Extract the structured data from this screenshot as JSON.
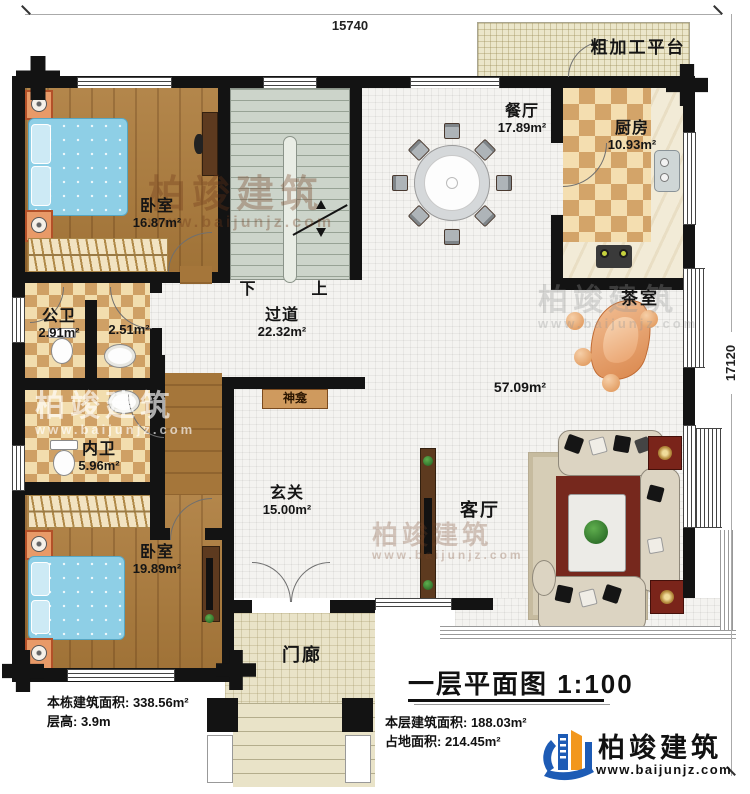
{
  "dimensions": {
    "top": "15740",
    "right": "17120"
  },
  "outdoor": {
    "platform_label": "粗加工平台",
    "porch_label": "门廊"
  },
  "rooms": {
    "bedroom_top": {
      "label": "卧室",
      "area": "16.87m²"
    },
    "bedroom_bottom": {
      "label": "卧室",
      "area": "19.89m²"
    },
    "dining": {
      "label": "餐厅",
      "area": "17.89m²"
    },
    "kitchen": {
      "label": "厨房",
      "area": "10.93m²"
    },
    "public_bath": {
      "label": "公卫",
      "area": "2.91m²"
    },
    "vanity": {
      "area": "2.51m²"
    },
    "ensuite_bath": {
      "label": "内卫",
      "area": "5.96m²"
    },
    "corridor": {
      "label": "过道",
      "area": "22.32m²"
    },
    "foyer": {
      "label": "玄关",
      "area": "15.00m²"
    },
    "tea_room": {
      "label": "茶室"
    },
    "living_room": {
      "label": "客厅"
    },
    "open_area": {
      "area": "57.09m²"
    },
    "shrine": {
      "label": "神龛"
    }
  },
  "stairs": {
    "down_label": "下",
    "up_label": "上"
  },
  "title_block": {
    "text": "一层平面图 1:100"
  },
  "stats": {
    "line1": "本栋建筑面积: 338.56m²",
    "line2": "层高: 3.9m",
    "line3": "本层建筑面积: 188.03m²",
    "line4": "占地面积: 214.45m²"
  },
  "logo": {
    "name": "柏竣建筑",
    "website": "www.baijunjz.com"
  },
  "watermark": {
    "name": "柏竣建筑",
    "website": "www.baijunjz.com"
  },
  "colors": {
    "wall": "#131313",
    "wood": "#ad7c3c",
    "tile": "#f4f3f0",
    "checker": "#d3a469",
    "stairs": "#ccd4ca",
    "logo_blue": "#1d5bb5",
    "logo_orange": "#f2971d"
  }
}
